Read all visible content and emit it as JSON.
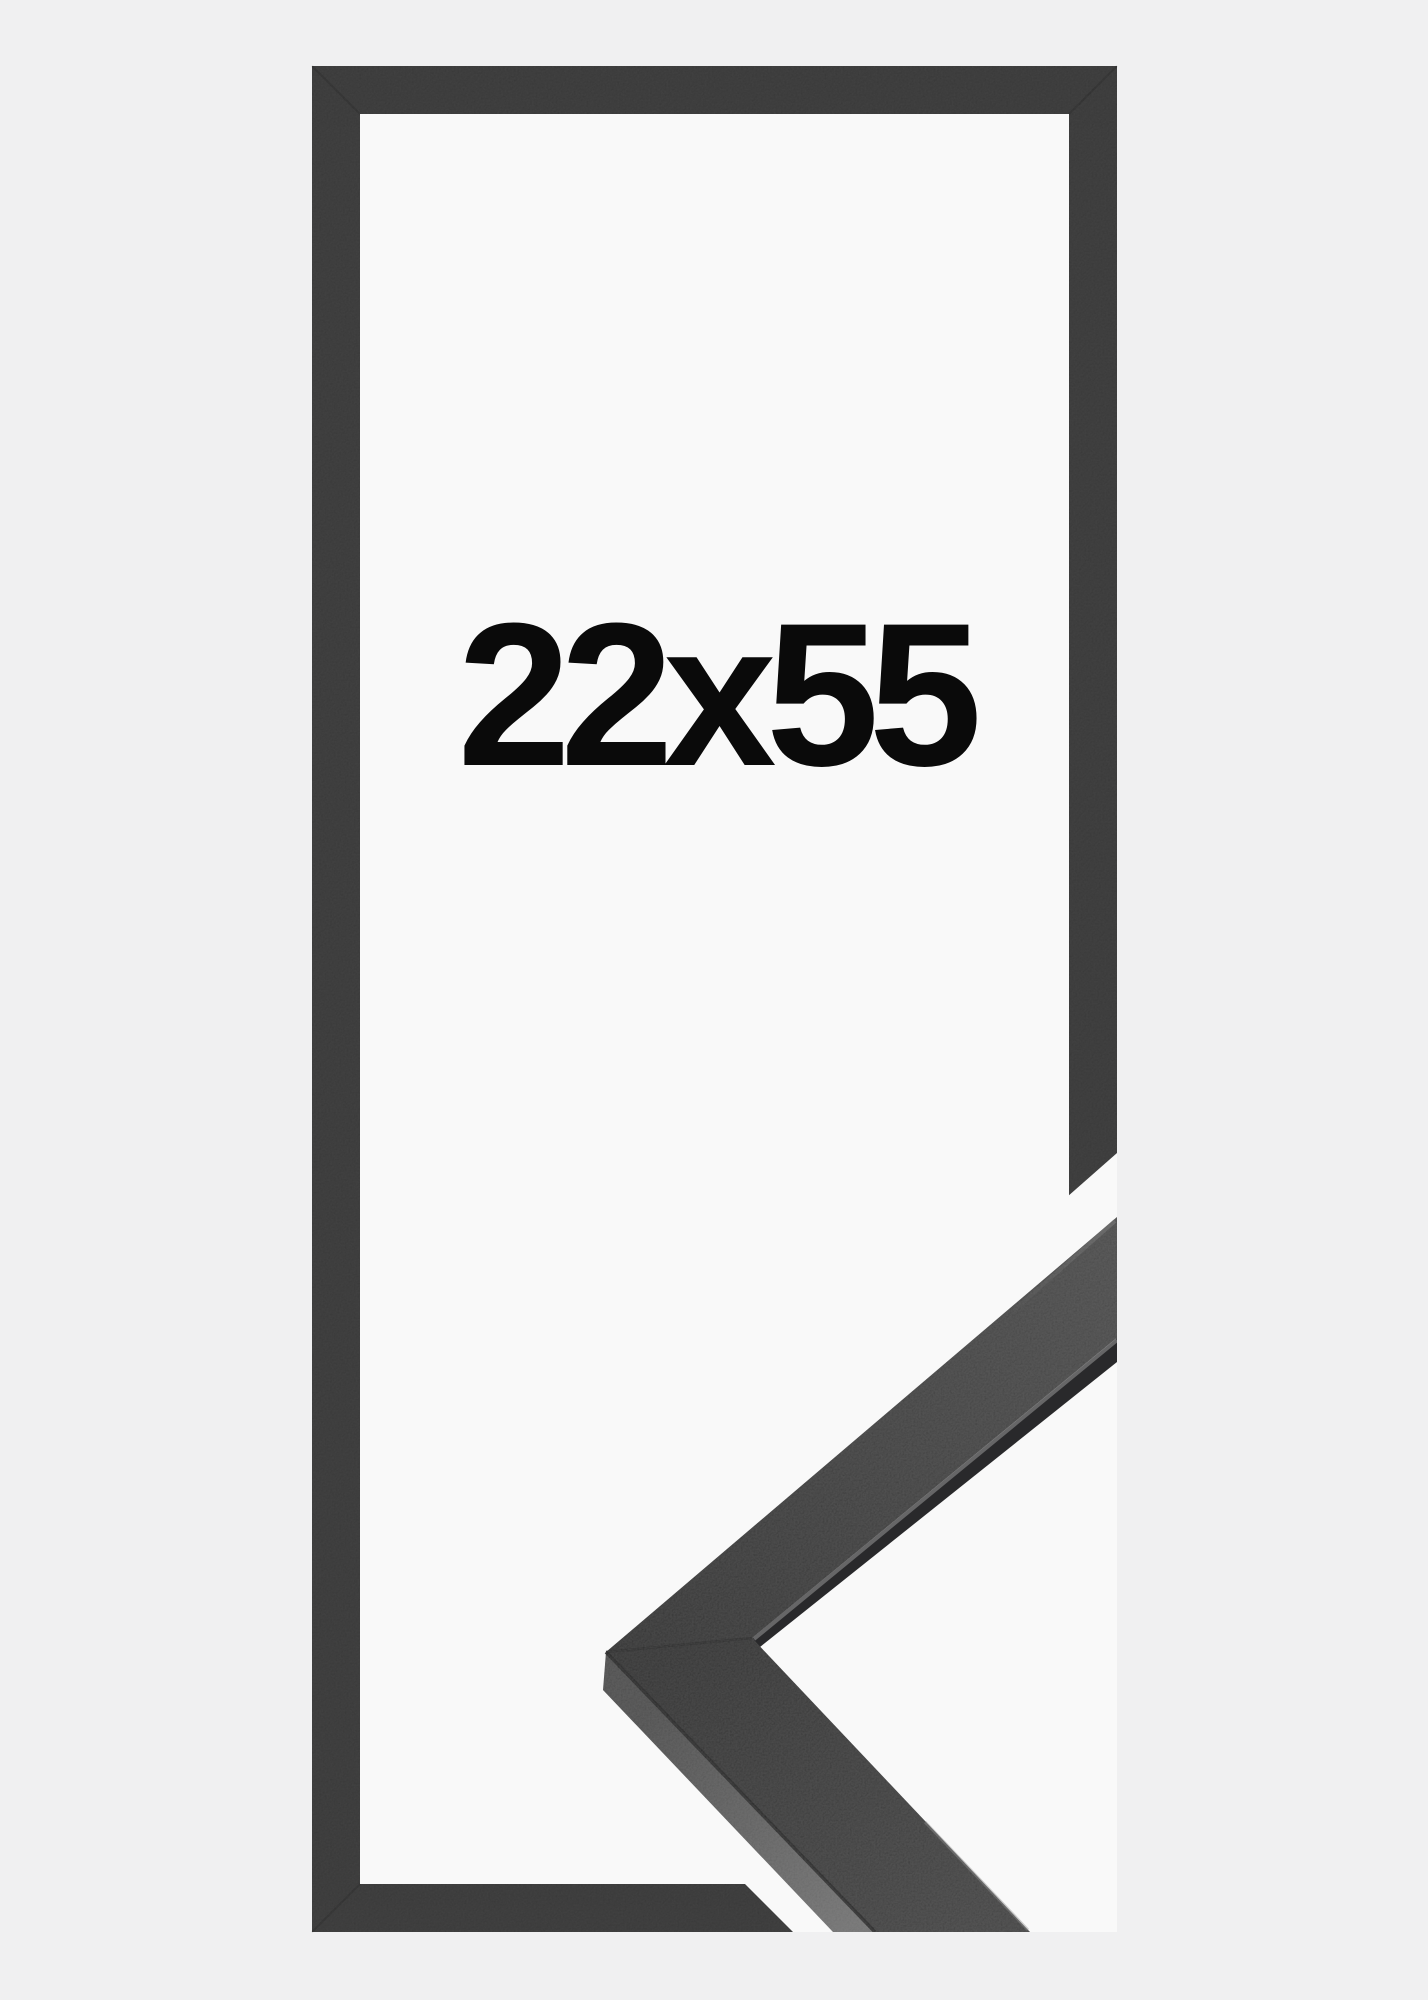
{
  "product": {
    "size_label": "22x55"
  },
  "colors": {
    "background": "#f0f0f1",
    "interior": "#f9f9f9",
    "flat_frame": "#353535",
    "text": "#0a0a0a",
    "moulding_top_dark": "#2c2c2c",
    "moulding_top_light": "#444444",
    "moulding_side_dark": "#474747",
    "moulding_side_light": "#6d6d6d",
    "edge_highlight": "#8f8f8f",
    "seam": "#1d1d1d"
  }
}
